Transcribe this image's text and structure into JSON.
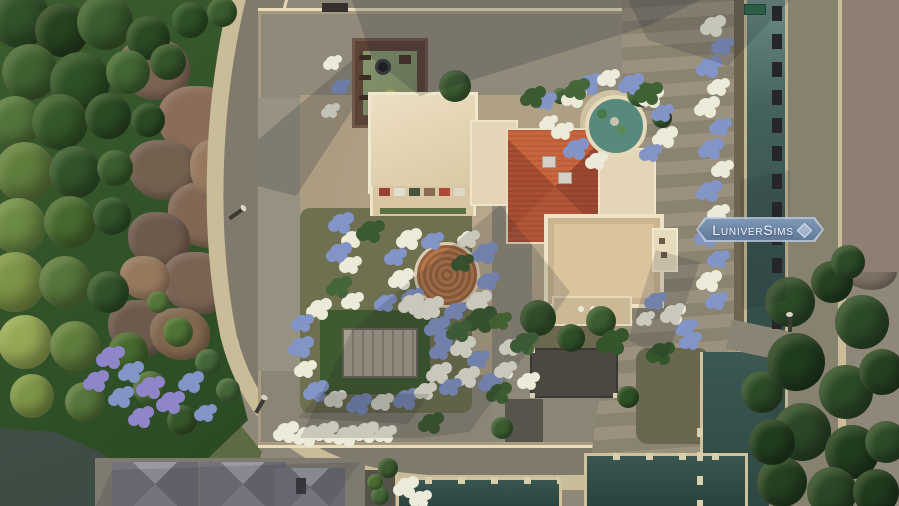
{
  "watermark": {
    "label": "LuniverSims",
    "gem_icon": "diamond-gem",
    "background": "#7e97b5",
    "text_color": "#f2f7fd"
  },
  "scene": {
    "description": "Top-down aerial view of a Mediterranean villa lot with gardens, tower, fountain and canals",
    "palette": {
      "forest_green": "#31522a",
      "cliff_brown": "#8a6c58",
      "road_gray": "#7f7a6b",
      "sidewalk_cream": "#c9bc99",
      "lot_gravel_tan": "#ab9c82",
      "roof_terracotta": "#b2563a",
      "roof_cream": "#e7d9ba",
      "tower_brick_brown": "#5a4336",
      "tower_terrace_green": "#7e8d6c",
      "canal_water_teal": "#3f5a55",
      "pool_water_dark": "#2f4843",
      "fountain_water_teal": "#57897d",
      "flower_blue": "#8394c6",
      "flower_white": "#ecead8",
      "flower_purple": "#8f86c9"
    },
    "trees": [
      [
        20,
        18,
        30,
        "#31522a"
      ],
      [
        62,
        30,
        27,
        "#26421f"
      ],
      [
        105,
        22,
        28,
        "#3a5c2e"
      ],
      [
        148,
        38,
        22,
        "#2b4a24"
      ],
      [
        190,
        20,
        18,
        "#2e5026"
      ],
      [
        222,
        12,
        15,
        "#3a5c2e"
      ],
      [
        30,
        72,
        28,
        "#3f6130"
      ],
      [
        80,
        82,
        30,
        "#2e5026"
      ],
      [
        128,
        72,
        22,
        "#426633"
      ],
      [
        168,
        62,
        18,
        "#35552a"
      ],
      [
        15,
        122,
        26,
        "#52743a"
      ],
      [
        60,
        122,
        28,
        "#355829"
      ],
      [
        108,
        116,
        23,
        "#2b4a24"
      ],
      [
        148,
        120,
        17,
        "#2b4a24"
      ],
      [
        25,
        172,
        30,
        "#5f7d3d"
      ],
      [
        75,
        172,
        26,
        "#31522a"
      ],
      [
        115,
        168,
        18,
        "#3a5c2e"
      ],
      [
        18,
        226,
        28,
        "#6b8a44"
      ],
      [
        70,
        222,
        26,
        "#47692f"
      ],
      [
        112,
        216,
        19,
        "#31522a"
      ],
      [
        15,
        282,
        30,
        "#7c9447"
      ],
      [
        65,
        282,
        26,
        "#55753a"
      ],
      [
        108,
        292,
        21,
        "#31522a"
      ],
      [
        25,
        342,
        27,
        "#94a855"
      ],
      [
        75,
        346,
        25,
        "#5f7d3d"
      ],
      [
        128,
        352,
        20,
        "#47692f"
      ],
      [
        32,
        396,
        22,
        "#7c9447"
      ],
      [
        85,
        402,
        20,
        "#55753a"
      ],
      [
        150,
        388,
        17,
        "#4a6b33"
      ],
      [
        182,
        420,
        15,
        "#35552a"
      ],
      [
        178,
        332,
        15,
        "#4f7335"
      ],
      [
        208,
        362,
        13,
        "#44663a"
      ],
      [
        158,
        302,
        11,
        "#55753a"
      ],
      [
        228,
        390,
        12,
        "#44663a"
      ],
      [
        455,
        86,
        16,
        "#3b5c31"
      ],
      [
        640,
        94,
        13,
        "#3f6134"
      ],
      [
        662,
        118,
        10,
        "#35552a"
      ],
      [
        560,
        96,
        8,
        "#44663a"
      ],
      [
        538,
        318,
        18,
        "#35552a"
      ],
      [
        571,
        338,
        14,
        "#2e4f28"
      ],
      [
        601,
        321,
        15,
        "#3b5c31"
      ],
      [
        628,
        397,
        11,
        "#2e5026"
      ],
      [
        502,
        428,
        11,
        "#3b5c31"
      ],
      [
        762,
        392,
        21,
        "#2c4a28"
      ],
      [
        790,
        302,
        25,
        "#2c4a28"
      ],
      [
        832,
        282,
        21,
        "#244020"
      ],
      [
        862,
        322,
        27,
        "#2c4a28"
      ],
      [
        796,
        362,
        29,
        "#203c1e"
      ],
      [
        846,
        392,
        27,
        "#2c4a28"
      ],
      [
        882,
        372,
        23,
        "#244020"
      ],
      [
        802,
        432,
        29,
        "#2a4626"
      ],
      [
        852,
        452,
        27,
        "#203c1e"
      ],
      [
        886,
        442,
        21,
        "#2c4a28"
      ],
      [
        782,
        482,
        25,
        "#244020"
      ],
      [
        832,
        492,
        25,
        "#2a4626"
      ],
      [
        876,
        492,
        23,
        "#1f3a1d"
      ],
      [
        772,
        442,
        23,
        "#203c1e"
      ],
      [
        848,
        262,
        17,
        "#2c4a28"
      ],
      [
        388,
        468,
        10,
        "#3c5a31"
      ],
      [
        380,
        496,
        9,
        "#44663a"
      ],
      [
        375,
        482,
        8,
        "#4a6b33"
      ]
    ],
    "rocks": [
      [
        118,
        38,
        72,
        62,
        "#7b6353"
      ],
      [
        158,
        86,
        84,
        72,
        "#8a6c58"
      ],
      [
        128,
        140,
        70,
        60,
        "#74604f"
      ],
      [
        168,
        182,
        78,
        66,
        "#826754"
      ],
      [
        128,
        212,
        62,
        56,
        "#6d5a4c"
      ],
      [
        162,
        252,
        72,
        62,
        "#7b6353"
      ],
      [
        108,
        300,
        66,
        56,
        "#6d5a4c"
      ],
      [
        150,
        308,
        60,
        52,
        "#82684f"
      ],
      [
        120,
        256,
        50,
        44,
        "#96785d"
      ],
      [
        190,
        140,
        48,
        60,
        "#96785d"
      ],
      [
        838,
        22,
        76,
        66,
        "#8a7d70"
      ],
      [
        858,
        82,
        72,
        76,
        "#93867a"
      ],
      [
        836,
        146,
        74,
        68,
        "#857868"
      ],
      [
        858,
        206,
        70,
        60,
        "#8d8073"
      ],
      [
        842,
        250,
        55,
        40,
        "#7e7264"
      ]
    ],
    "flowers": [
      [
        712,
        25,
        8,
        "#ecead8"
      ],
      [
        722,
        45,
        7,
        "#8394c6"
      ],
      [
        708,
        66,
        8,
        "#8394c6"
      ],
      [
        718,
        86,
        7,
        "#ecead8"
      ],
      [
        706,
        106,
        8,
        "#ecead8"
      ],
      [
        720,
        126,
        7,
        "#8394c6"
      ],
      [
        710,
        148,
        8,
        "#8394c6"
      ],
      [
        722,
        168,
        7,
        "#ecead8"
      ],
      [
        708,
        190,
        8,
        "#8394c6"
      ],
      [
        718,
        212,
        7,
        "#ecead8"
      ],
      [
        706,
        235,
        8,
        "#8394c6"
      ],
      [
        718,
        258,
        7,
        "#8394c6"
      ],
      [
        708,
        280,
        8,
        "#ecead8"
      ],
      [
        716,
        300,
        7,
        "#8394c6"
      ],
      [
        573,
        96,
        8,
        "#ecead8"
      ],
      [
        588,
        83,
        8,
        "#8394c6"
      ],
      [
        608,
        77,
        7,
        "#ecead8"
      ],
      [
        630,
        83,
        8,
        "#8394c6"
      ],
      [
        650,
        96,
        8,
        "#ecead8"
      ],
      [
        662,
        112,
        7,
        "#8394c6"
      ],
      [
        664,
        136,
        8,
        "#ecead8"
      ],
      [
        650,
        152,
        7,
        "#8394c6"
      ],
      [
        575,
        148,
        8,
        "#8394c6"
      ],
      [
        562,
        130,
        7,
        "#ecead8"
      ],
      [
        596,
        160,
        7,
        "#ecead8"
      ],
      [
        545,
        100,
        7,
        "#8394c6"
      ],
      [
        548,
        122,
        6,
        "#ecead8"
      ],
      [
        340,
        222,
        8,
        "#8394c6"
      ],
      [
        352,
        238,
        7,
        "#ecead8"
      ],
      [
        338,
        252,
        8,
        "#8394c6"
      ],
      [
        350,
        264,
        7,
        "#ecead8"
      ],
      [
        332,
        62,
        6,
        "#ecead8"
      ],
      [
        340,
        86,
        6,
        "#8394c6"
      ],
      [
        330,
        110,
        6,
        "#ecead8"
      ],
      [
        408,
        238,
        8,
        "#ecead8"
      ],
      [
        395,
        256,
        7,
        "#8394c6"
      ],
      [
        400,
        278,
        8,
        "#ecead8"
      ],
      [
        412,
        296,
        7,
        "#8394c6"
      ],
      [
        430,
        306,
        8,
        "#ecead8"
      ],
      [
        455,
        310,
        7,
        "#8394c6"
      ],
      [
        478,
        300,
        8,
        "#ecead8"
      ],
      [
        488,
        280,
        7,
        "#8394c6"
      ],
      [
        484,
        252,
        8,
        "#8394c6"
      ],
      [
        468,
        238,
        7,
        "#ecead8"
      ],
      [
        432,
        240,
        7,
        "#8394c6"
      ],
      [
        318,
        308,
        8,
        "#ecead8"
      ],
      [
        302,
        322,
        7,
        "#8394c6"
      ],
      [
        300,
        346,
        8,
        "#8394c6"
      ],
      [
        305,
        368,
        7,
        "#ecead8"
      ],
      [
        315,
        390,
        8,
        "#8394c6"
      ],
      [
        335,
        398,
        7,
        "#ecead8"
      ],
      [
        358,
        403,
        8,
        "#8394c6"
      ],
      [
        382,
        401,
        7,
        "#ecead8"
      ],
      [
        405,
        398,
        8,
        "#8394c6"
      ],
      [
        425,
        390,
        7,
        "#ecead8"
      ],
      [
        438,
        372,
        8,
        "#ecead8"
      ],
      [
        440,
        350,
        7,
        "#8394c6"
      ],
      [
        436,
        326,
        8,
        "#8394c6"
      ],
      [
        424,
        310,
        7,
        "#ecead8"
      ],
      [
        352,
        300,
        7,
        "#ecead8"
      ],
      [
        385,
        302,
        7,
        "#8394c6"
      ],
      [
        410,
        303,
        8,
        "#ecead8"
      ],
      [
        445,
        336,
        7,
        "#8394c6"
      ],
      [
        462,
        346,
        8,
        "#ecead8"
      ],
      [
        478,
        358,
        7,
        "#8394c6"
      ],
      [
        466,
        376,
        8,
        "#ecead8"
      ],
      [
        450,
        386,
        7,
        "#8394c6"
      ],
      [
        490,
        381,
        8,
        "#8394c6"
      ],
      [
        505,
        369,
        7,
        "#ecead8"
      ],
      [
        510,
        346,
        7,
        "#ecead8"
      ],
      [
        528,
        380,
        7,
        "#ecead8"
      ],
      [
        655,
        300,
        7,
        "#8394c6"
      ],
      [
        672,
        313,
        8,
        "#ecead8"
      ],
      [
        686,
        327,
        7,
        "#8394c6"
      ],
      [
        645,
        318,
        6,
        "#ecead8"
      ],
      [
        690,
        340,
        7,
        "#8394c6"
      ],
      [
        110,
        356,
        9,
        "#8f86c9"
      ],
      [
        130,
        371,
        8,
        "#8394c6"
      ],
      [
        150,
        386,
        9,
        "#8f86c9"
      ],
      [
        120,
        396,
        8,
        "#8394c6"
      ],
      [
        170,
        401,
        9,
        "#8f86c9"
      ],
      [
        140,
        416,
        8,
        "#8f86c9"
      ],
      [
        190,
        381,
        8,
        "#8394c6"
      ],
      [
        205,
        412,
        7,
        "#8394c6"
      ],
      [
        95,
        380,
        8,
        "#8f86c9"
      ],
      [
        285,
        431,
        8,
        "#ecead8"
      ],
      [
        305,
        435,
        8,
        "#ecead8"
      ],
      [
        325,
        431,
        8,
        "#ecead8"
      ],
      [
        345,
        435,
        8,
        "#ecead8"
      ],
      [
        365,
        431,
        8,
        "#ecead8"
      ],
      [
        385,
        433,
        7,
        "#ecead8"
      ],
      [
        405,
        486,
        8,
        "#ecead8"
      ],
      [
        420,
        498,
        7,
        "#ecead8"
      ],
      [
        370,
        230,
        9,
        "#3c5a31"
      ],
      [
        480,
        318,
        10,
        "#3c5a31"
      ],
      [
        524,
        342,
        9,
        "#44663a"
      ],
      [
        612,
        340,
        10,
        "#35552a"
      ],
      [
        648,
        92,
        9,
        "#3f6134"
      ],
      [
        576,
        88,
        8,
        "#44663a"
      ],
      [
        532,
        96,
        8,
        "#3c5a31"
      ],
      [
        458,
        330,
        8,
        "#44663a"
      ],
      [
        498,
        392,
        8,
        "#3c5a31"
      ],
      [
        338,
        286,
        8,
        "#44663a"
      ],
      [
        462,
        262,
        7,
        "#3c5a31"
      ],
      [
        500,
        320,
        7,
        "#4a6b33"
      ],
      [
        430,
        422,
        8,
        "#3c5a31"
      ],
      [
        660,
        352,
        9,
        "#35552a"
      ]
    ],
    "canal_posts_dark": {
      "x": 772,
      "y0": 6,
      "step": 28,
      "count": 12,
      "w": 10,
      "h": 15,
      "color": "#26262a"
    },
    "canal_posts_cream": {
      "x": 697,
      "y0": 428,
      "step": 24,
      "count": 4,
      "w": 6,
      "h": 9,
      "color": "#d8cfae"
    },
    "stall_colors": [
      "#9a4034",
      "#e3ded0",
      "#47523e",
      "#8a6a50",
      "#b0483a",
      "#ddd8c8"
    ]
  }
}
